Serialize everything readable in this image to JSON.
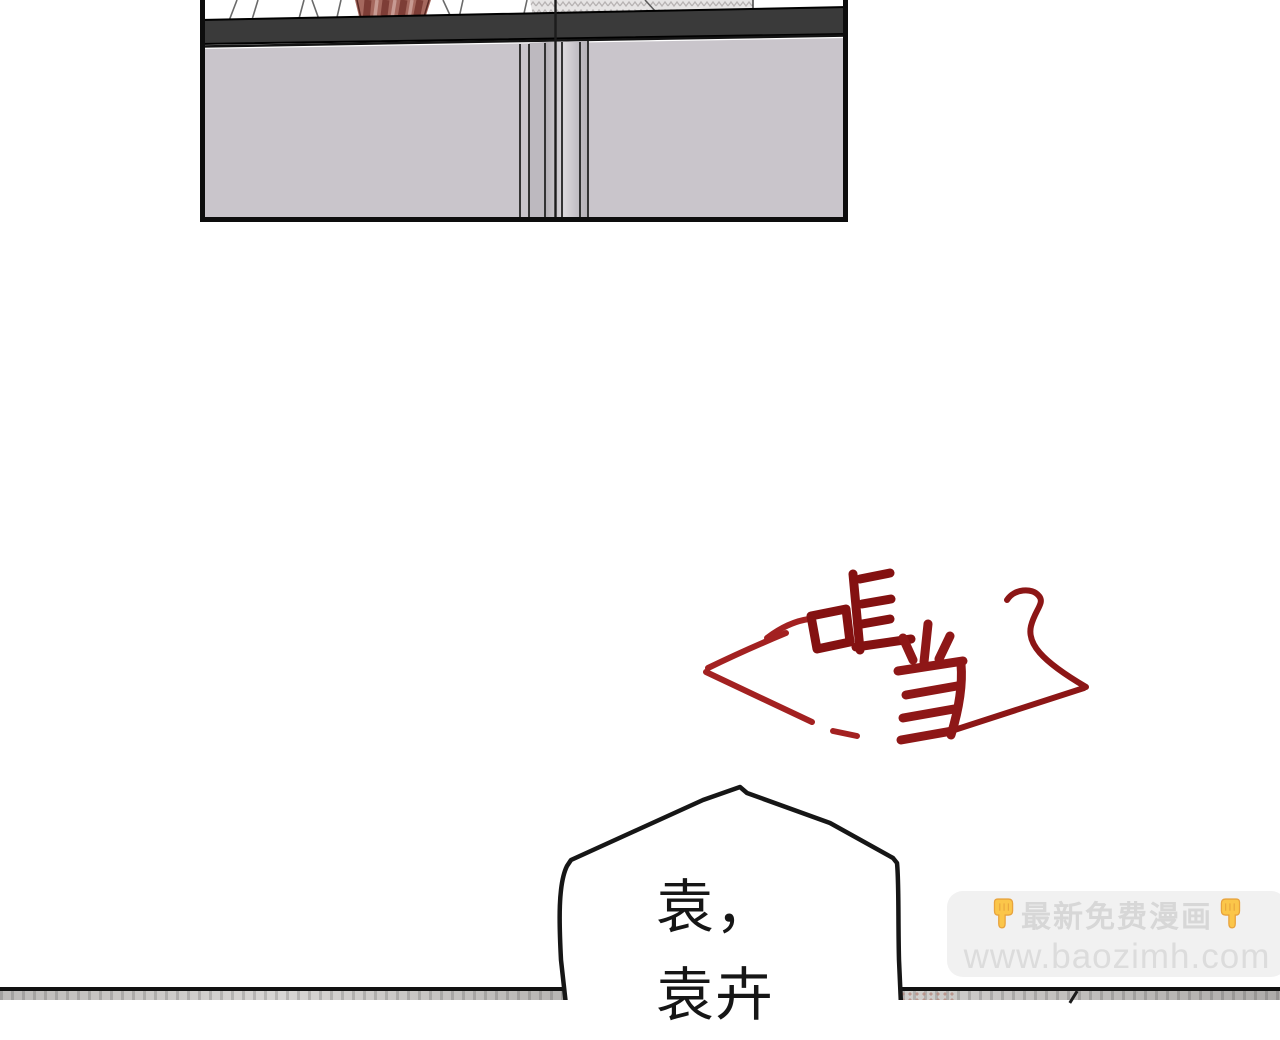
{
  "page": {
    "background": "#ffffff"
  },
  "top_panel": {
    "border_color": "#0d0d0d",
    "cabinet_color": "#c9c5cb",
    "counter_band_color": "#3a3a3a",
    "red_fabric_color": "#a5685e"
  },
  "sfx": {
    "text": "哐当",
    "color": "#841111",
    "accent_color": "#a32121"
  },
  "speech_bubble": {
    "line1": "袁，",
    "line2": "袁卉",
    "fill": "#ffffff",
    "stroke": "#161616"
  },
  "watermark": {
    "line1": "最新免费漫画",
    "line2": "www.baozimh.com",
    "left_icon": "👇",
    "right_icon": "👇",
    "background": "#f1f1f1",
    "text_color": "#d7d7d7",
    "finger_color": "#fbc64a"
  },
  "next_panel_strip": {
    "line_color": "#111111",
    "fill_color": "#c4c2c0"
  }
}
